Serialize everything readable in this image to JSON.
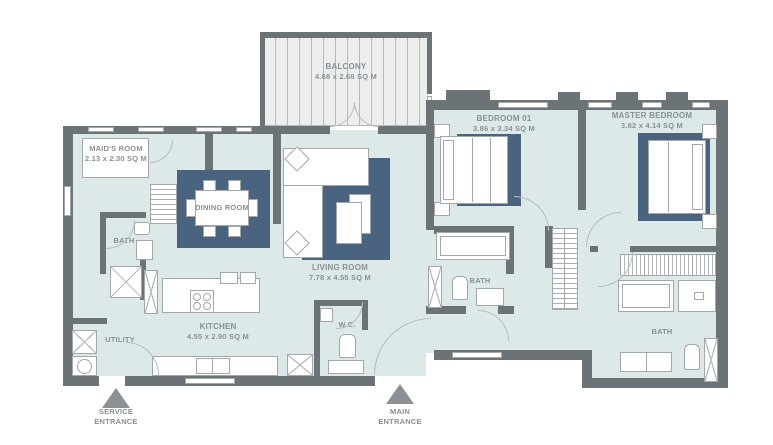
{
  "meta": {
    "type": "apartment-floor-plan"
  },
  "colors": {
    "floor": "#dde9e8",
    "wall": "#6c7377",
    "rug": "#4a6480",
    "furniture_outline": "#a2a7aa",
    "label_text": "#8a9094",
    "entrance_arrow": "#8a9094"
  },
  "rooms": {
    "balcony": {
      "name": "BALCONY",
      "dims": "4.68 x 2.68 SQ M"
    },
    "maids_room": {
      "name": "MAID'S ROOM",
      "dims": "2.13 x 2.30 SQ M"
    },
    "dining_room": {
      "name": "DINING ROOM"
    },
    "living_room": {
      "name": "LIVING ROOM",
      "dims": "7.78 x 4.55 SQ M"
    },
    "kitchen": {
      "name": "KITCHEN",
      "dims": "4.55 x 2.90 SQ M"
    },
    "bedroom_01": {
      "name": "BEDROOM 01",
      "dims": "3.86 x 3.34 SQ M"
    },
    "master_bedroom": {
      "name": "MASTER BEDROOM",
      "dims": "3.82 x 4.14 SQ M"
    },
    "maids_bath": {
      "name": "BATH"
    },
    "bedroom_bath": {
      "name": "BATH"
    },
    "master_bath": {
      "name": "BATH"
    },
    "utility": {
      "name": "UTILITY"
    },
    "wc": {
      "name": "W.C."
    }
  },
  "entrances": {
    "service": {
      "line1": "SERVICE",
      "line2": "ENTRANCE"
    },
    "main": {
      "line1": "MAIN",
      "line2": "ENTRANCE"
    }
  }
}
